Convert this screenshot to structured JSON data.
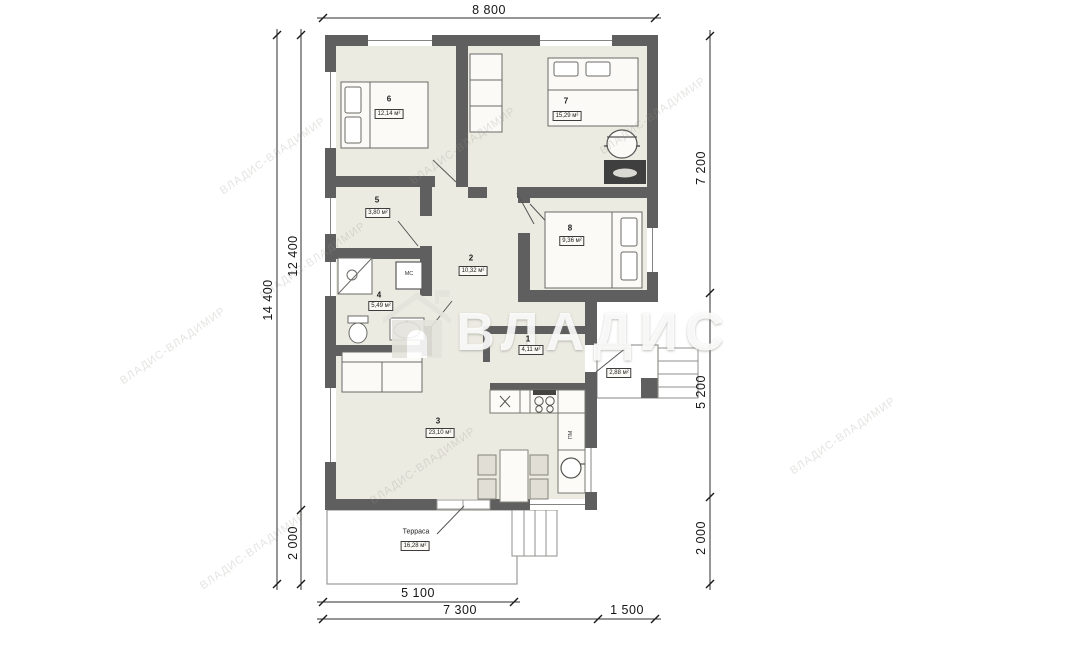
{
  "plan": {
    "title": "floor-plan",
    "dimensions": {
      "top": "8 800",
      "left_outer": "14 400",
      "left_inner": "12 400",
      "left_bottom": "2 000",
      "right_top": "7 200",
      "right_middle": "5 200",
      "right_bottom": "2 000",
      "bottom_terrace": "5 100",
      "bottom_main": "7 300",
      "bottom_porch": "1 500"
    },
    "rooms": [
      {
        "number": "6",
        "area": "12,14 м²"
      },
      {
        "number": "7",
        "area": "15,29 м²"
      },
      {
        "number": "5",
        "area": "3,80 м²"
      },
      {
        "number": "2",
        "area": "10,32 м²"
      },
      {
        "number": "8",
        "area": "9,36 м²"
      },
      {
        "number": "4",
        "area": "5,49 м²"
      },
      {
        "number": "1",
        "area": "4,11 м²"
      },
      {
        "number": "3",
        "area": "23,10 м²"
      }
    ],
    "porch": {
      "area": "2,88 м²"
    },
    "terrace": {
      "name": "Терраса",
      "area": "16,28 м²"
    },
    "appliances": {
      "washing_machine": "МС",
      "dishwasher": "ПМ"
    },
    "watermark": {
      "text": "ВЛАДИС",
      "tiled_text": "ВЛАДИС-ВЛАДИМИР"
    },
    "colors": {
      "wall": "#5f5f5f",
      "floor": "#ecebe2"
    }
  }
}
